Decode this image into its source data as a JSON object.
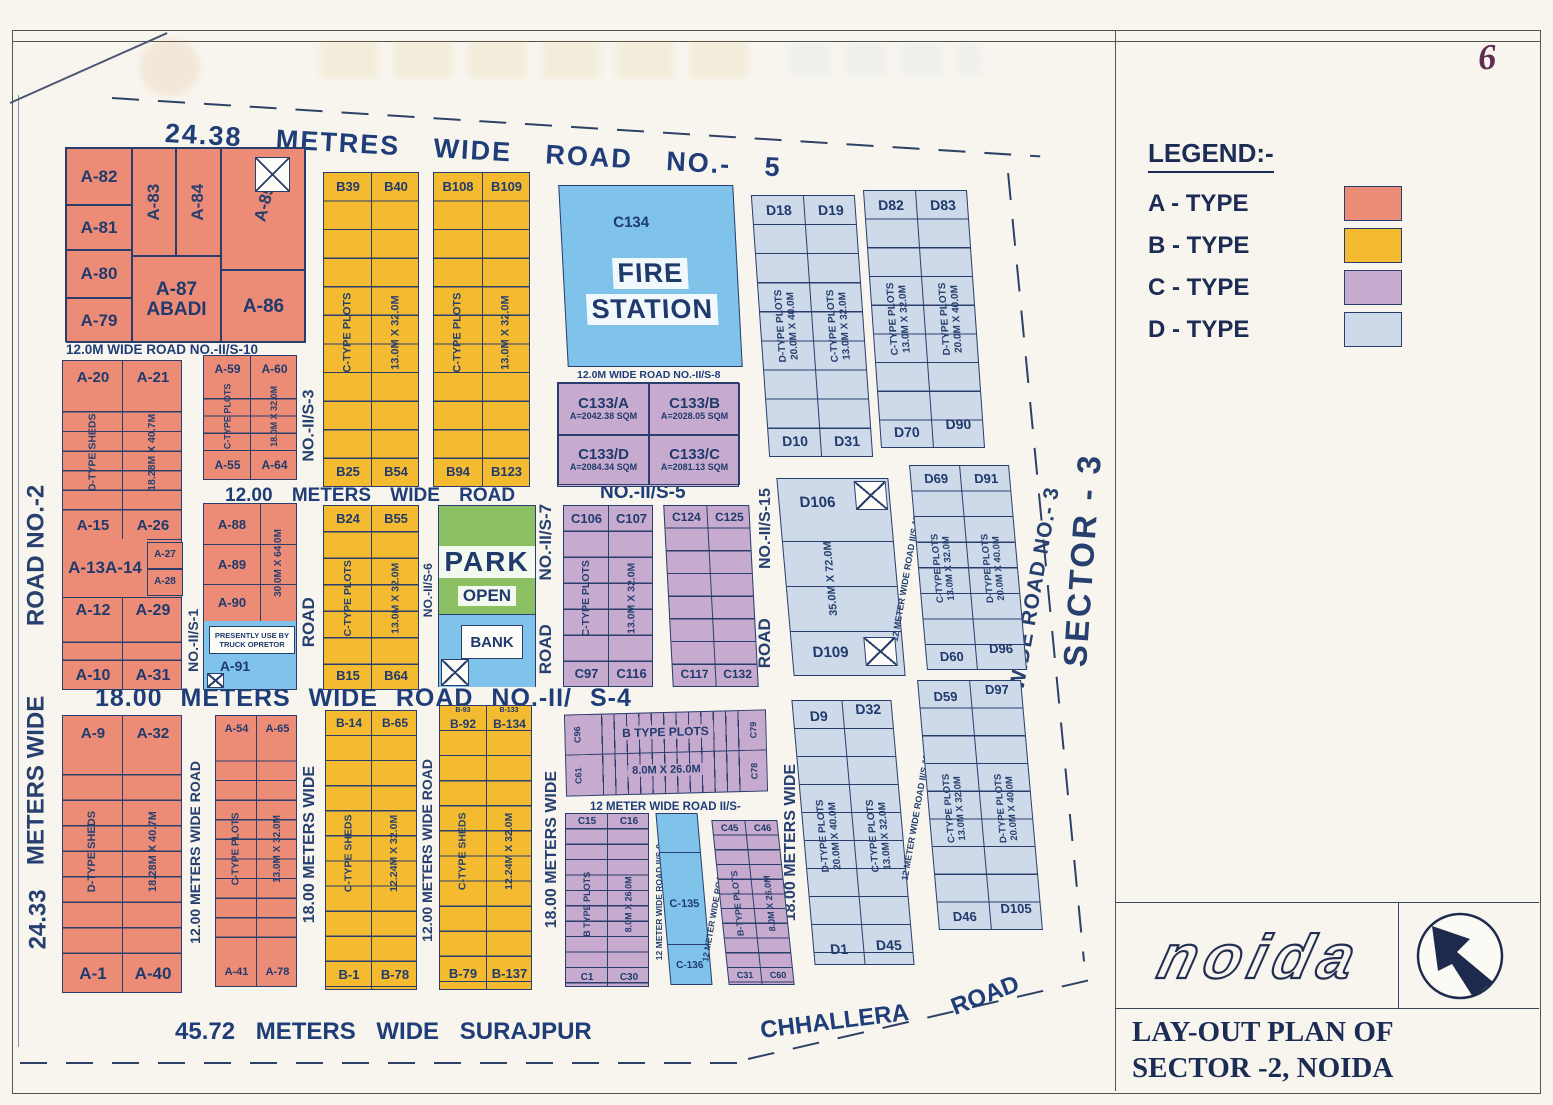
{
  "page_number": "6",
  "colors": {
    "a_type": "#ED8C76",
    "b_type": "#F5BB30",
    "c_type": "#C7ABCE",
    "d_type": "#CED9E9",
    "special_blue": "#7FC3EB",
    "park_green": "#8CC063",
    "ink": "#23407C"
  },
  "legend": {
    "title": "LEGEND:-",
    "items": [
      {
        "label": "A - TYPE",
        "color": "#ED8C76"
      },
      {
        "label": "B - TYPE",
        "color": "#F5BB30"
      },
      {
        "label": "C - TYPE",
        "color": "#C7ABCE"
      },
      {
        "label": "D - TYPE",
        "color": "#CED9E9"
      }
    ]
  },
  "title_block": {
    "logo": "noida",
    "line1": "LAY-OUT PLAN OF",
    "line2": "SECTOR -2,  NOIDA"
  },
  "roads": {
    "top": "24.38 METRES WIDE ROAD NO.- 5",
    "s10": "12.0M WIDE ROAD NO.-II/S-10",
    "mid12": "12.00 METERS WIDE ROAD",
    "s5": "NO.-II/S-5",
    "s8": "12.0M WIDE ROAD NO.-II/S-8",
    "s4": "18.00 METERS WIDE ROAD NO.-II/ S-4",
    "left_name": "ROAD NO.-2",
    "left_mid": "METERS WIDE",
    "left_width": "24.33",
    "s1": "NO.-II/S-1",
    "s3": "NO.-II/S-3",
    "road_word": "ROAD",
    "wide18": "18.00 METERS WIDE",
    "v12": "12.00 METERS WIDE ROAD",
    "v18": "18.00 METERS WIDE ROAD",
    "s6": "NO.-II/S-6",
    "s7": "NO.-II/S-7",
    "s15": "NO.-II/S-15",
    "s17": "12 METER WIDE ROAD II/S-17",
    "s9": "12 METER WIDE ROAD II/S-9",
    "s13": "12 METER WIDE ROAD II/S-13",
    "s_c": "12 METER WIDE ROAD II/S-",
    "road3": "24.38 METERS WIDE ROAD NO.- 3",
    "sector3": "SECTOR - 3",
    "surajpur": "45.72 METERS WIDE SURAJPUR",
    "chhallera": "CHHALLERA",
    "road": "ROAD"
  },
  "blocks": {
    "a1": {
      "a82": "A-82",
      "a81": "A-81",
      "a80": "A-80",
      "a79": "A-79",
      "a83": "A-83",
      "a84": "A-84",
      "a85": "A-85",
      "a87": "A-87",
      "abadi": "ABADI",
      "a86": "A-86"
    },
    "a2": {
      "a20": "A-20",
      "a21": "A-21",
      "shed": "D-TYPE SHEDS",
      "dim": "18.28M X 40.7M",
      "a15": "A-15",
      "a26": "A-26",
      "a13": "A-13",
      "a14": "A-14",
      "a27": "A-27",
      "a28": "A-28",
      "a12": "A-12",
      "a29": "A-29",
      "a10": "A-10",
      "a31": "A-31"
    },
    "a3": {
      "a59": "A-59",
      "a60": "A-60",
      "label": "C-TYPE PLOTS",
      "dim": "18.0M X 32.0M",
      "a55": "A-55",
      "a64": "A-64"
    },
    "a4": {
      "a88": "A-88",
      "a89": "A-89",
      "a90": "A-90",
      "dim": "30.0M X 64.0M",
      "note1": "PRESENTLY USE BY",
      "note2": "TRUCK OPRETOR",
      "a91": "A-91"
    },
    "a5": {
      "a9": "A-9",
      "a32": "A-32",
      "shed": "D-TYPE SHEDS",
      "dim": "18.28M X 40.7M",
      "a1": "A-1",
      "a40": "A-40"
    },
    "a6": {
      "a54": "A-54",
      "a65": "A-65",
      "label": "C-TYPE PLOTS",
      "dim": "13.0M X 32.0M",
      "a41": "A-41",
      "a78": "A-78"
    },
    "b1": {
      "t1": "B39",
      "t2": "B40",
      "label": "C-TYPE PLOTS",
      "dim": "13.0M X 32.0M",
      "b1": "B25",
      "b2": "B54"
    },
    "b2": {
      "t1": "B108",
      "t2": "B109",
      "label": "C-TYPE PLOTS",
      "dim": "13.0M X 32.0M",
      "b1": "B94",
      "b2": "B123"
    },
    "b3": {
      "t1": "B24",
      "t2": "B55",
      "label": "C-TYPE PLOTS",
      "dim": "13.0M X 32.0M",
      "b1": "B15",
      "b2": "B64"
    },
    "b4": {
      "t1": "B-14",
      "t2": "B-65",
      "label": "C-TYPE SHEDS",
      "dim": "12.24M X 32.0M",
      "b1": "B-1",
      "b2": "B-78"
    },
    "b5": {
      "s1": "B-93",
      "s2": "B-133",
      "t1": "B-92",
      "t2": "B-134",
      "label": "C-TYPE SHEDS",
      "dim": "12.24M X 32.0M",
      "b1": "B-79",
      "b2": "B-137"
    },
    "fire": {
      "plot": "C134",
      "l1": "FIRE",
      "l2": "STATION"
    },
    "c133": {
      "a": "C133/A",
      "a_area": "A=2042.38 SQM",
      "b": "C133/B",
      "b_area": "A=2028.05 SQM",
      "d": "C133/D",
      "d_area": "A=2084.34 SQM",
      "c": "C133/C",
      "c_area": "A=2081.13 SQM"
    },
    "park": {
      "l1": "PARK",
      "l2": "OPEN"
    },
    "bank": "BANK",
    "c1": {
      "t1": "C106",
      "t2": "C107",
      "label": "C-TYPE PLOTS",
      "dim": "13.0M X 32.0M",
      "b1": "C97",
      "b2": "C116"
    },
    "c2": {
      "t1": "C124",
      "t2": "C125",
      "b1": "C117",
      "b2": "C132"
    },
    "strip": {
      "tl": "C96",
      "bl": "C61",
      "label": "B TYPE PLOTS",
      "dim": "8.0M X 26.0M",
      "tr": "C79",
      "br": "C78"
    },
    "c3": {
      "t1": "C15",
      "t2": "C16",
      "label": "B TYPE PLOTS",
      "dim": "8.0M X 26.0M",
      "b1": "C1",
      "b2": "C30"
    },
    "c5": {
      "p1": "C-135",
      "p2": "C-136"
    },
    "c4": {
      "t1": "C45",
      "t2": "C46",
      "label": "B-TYPE PLOTS",
      "dim": "8.0M X 26.0M",
      "b1": "C31",
      "b2": "C60"
    },
    "d1": {
      "t1": "D18",
      "t2": "D19",
      "l1": "D-TYPE PLOTS",
      "l1d": "20.0M X 40.0M",
      "l2": "C-TYPE PLOTS",
      "l2d": "13.0M X 32.0M",
      "b1": "D10",
      "b2": "D31"
    },
    "d2": {
      "t1": "D82",
      "t2": "D83",
      "l1": "C-TYPE PLOTS",
      "l1d": "13.0M X 32.0M",
      "l2": "D-TYPE PLOTS",
      "l2d": "20.0M X 40.0M",
      "b1": "D70",
      "b2": "D90"
    },
    "d3": {
      "t": "D106",
      "dim": "35.0M X 72.0M",
      "b": "D109"
    },
    "d4": {
      "t1": "D69",
      "t2": "D91",
      "l1": "C-TYPE PLOTS",
      "l1d": "13.0M X 32.0M",
      "l2": "D-TYPE PLOTS",
      "l2d": "20.0M X 40.0M",
      "b1": "D60",
      "b2": "D96"
    },
    "d5": {
      "t1": "D9",
      "t2": "D32",
      "l1": "D-TYPE PLOTS",
      "l1d": "20.0M X 40.0M",
      "l2": "C-TYPE PLOTS",
      "l2d": "13.0M X 32.0M",
      "b1": "D1",
      "b2": "D45"
    },
    "d6": {
      "t1": "D59",
      "t2": "D97",
      "l1": "C-TYPE PLOTS",
      "l1d": "13.0M X 32.0M",
      "l2": "D-TYPE PLOTS",
      "l2d": "20.0M X 40.0M",
      "b1": "D46",
      "b2": "D105"
    }
  }
}
